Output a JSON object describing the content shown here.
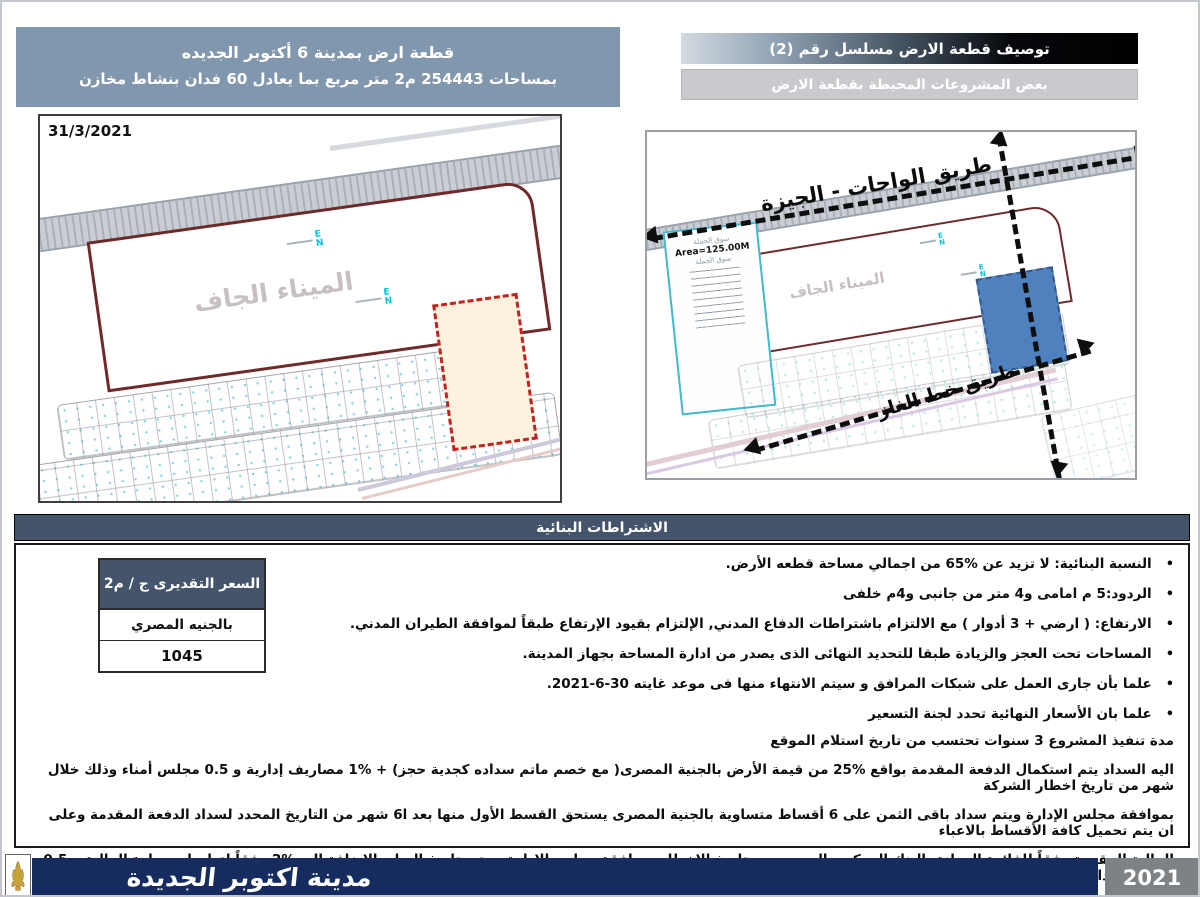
{
  "header": {
    "left_box_line1": "قطعة ارض بمدينة 6 أكتوبر الجديده",
    "left_box_line2": "بمساحات 254443 م2 متر مربع بما يعادل 60 فدان  بنشاط مخازن",
    "title_bar": "توصيف قطعة الارض مسلسل رقم (2)",
    "subtitle_bar": "بعض المشروعات المحيطة بقطعة الارض"
  },
  "left_map": {
    "date": "31/3/2021",
    "port_label": "الميناء الجاف",
    "marker_e": "E",
    "marker_n": "N"
  },
  "right_map": {
    "road_top_label": "طريق الواحات - الجيزة",
    "road_bottom_label": "طريق خط الغاز",
    "port_label": "الميناء الجاف",
    "market_label_top": "سوق الجملة",
    "area_label": "Area=125.00M",
    "market_label_bottom": "سوق الجملة"
  },
  "section_bar": "الاشتراطات البنائية",
  "conditions": [
    "النسبة البنائية: لا تزيد عن %65 من اجمالي مساحة قطعه الأرض.",
    "الردود:5 م امامى و4 متر من جانبى و4م خلفى",
    "الارتفاع: ( ارضي + 3 أدوار ) مع الالتزام باشتراطات الدفاع المدني, الإلتزام بقيود الإرتفاع طبقاً لموافقة الطيران المدني.",
    "المساحات تحت العجز والزيادة طبقا للتحديد النهائى الذى يصدر من ادارة المساحة بجهاز المدينة.",
    "علما بأن جارى العمل على شبكات المرافق و سيتم الانتهاء منها فى موعد غايته 30-6-2021.",
    "علما بان الأسعار النهائية تحدد لجنة التسعير"
  ],
  "price_table": {
    "header": "السعر التقديرى ج / م2",
    "currency": "بالجنيه المصري",
    "value": "1045"
  },
  "duration_line": "مدة تنفيذ المشروع 3 سنوات تحتسب من تاريخ استلام الموقع",
  "payment_lines": [
    "اليه السداد يتم استكمال الدفعة المقدمة بواقع %25 من قيمة الأرض بالجنية المصرى( مع خصم ماتم سداده كجدية حجز) + %1 مصاريف إدارية و 0.5 مجلس أمناء وذلك خلال شهر من تاريخ اخطار الشركة",
    "بموافقة مجلس الإدارة ويتم سداد باقى الثمن على 6 أقساط متساوية بالجنية المصرى يستحق القسط الأول منها بعد ا6 شهر من التاريخ المحدد لسداد الدفعة المقدمة وعلى ان يتم تحميل كافة الأقساط بالاعباء",
    "المالية المقررة وفقاً للفائدة المعلنة بالبنك المركزى المصرى مع تاريخ الاخطار بموافقة مجلس الإدارة وحتى تاريخ الساد بالإضافة الى %2 وفقاً لتعليمات وزارة المالية و 0.5 مصاريف ادارية"
  ],
  "footer": {
    "city": "مدينة اكتوبر الجديدة",
    "year": "2021"
  },
  "colors": {
    "section_bar": "#44546a",
    "footer_navy": "#162b5e",
    "plot_blue": "#4e81bd",
    "dashed_red": "#c42222",
    "header_box_blue": "#8197ad"
  }
}
